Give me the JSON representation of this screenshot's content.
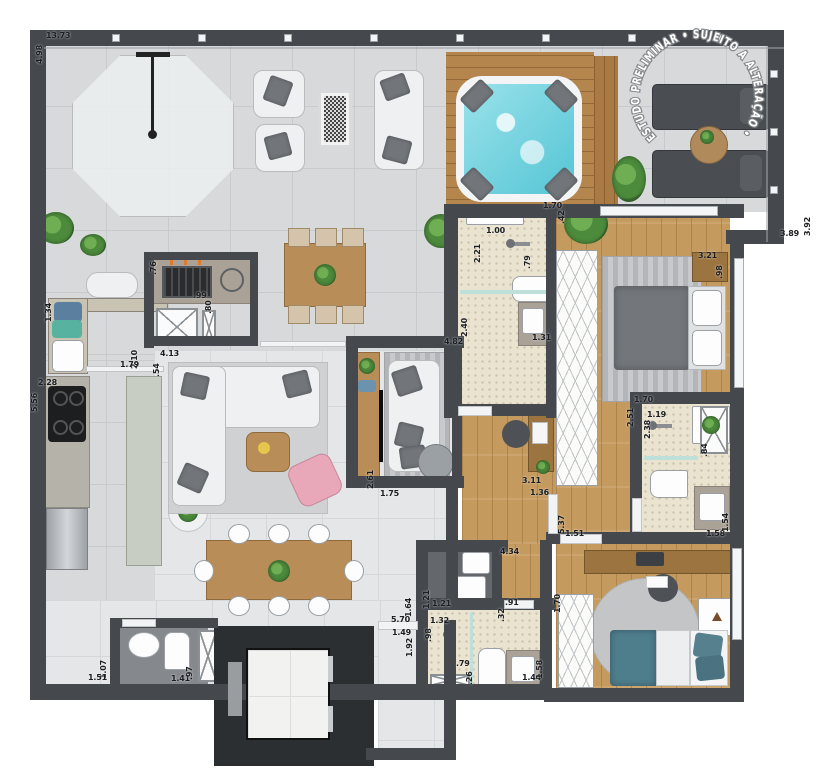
{
  "plan": {
    "watermark": "ESTUDO PRELIMINAR • SUJEITO A ALTERAÇÃO •",
    "colors": {
      "wall": "#45494e",
      "terrace_floor": "#d7d9db",
      "interior_floor": "#e4e6e8",
      "wood_floor": "#c59a5e",
      "deck_wood": "#b5854e",
      "bath_mosaic": "#eae3d0",
      "dark_floor": "#64676b",
      "jacuzzi_water": "#7fd8e2",
      "island_sage": "#c7cdc2",
      "accent_pink": "#e9a8b9",
      "bed_teal": "#4e7d8c",
      "plant_green": "#4c8a3c"
    },
    "dimensions": [
      {
        "v": "13.73",
        "x": 46,
        "y": 32,
        "r": 0
      },
      {
        "v": "4.98",
        "x": 36,
        "y": 64,
        "r": 1
      },
      {
        "v": "3.89",
        "x": 780,
        "y": 230,
        "r": 0
      },
      {
        "v": "3.92",
        "x": 804,
        "y": 236,
        "r": 1
      },
      {
        "v": "1.70",
        "x": 543,
        "y": 202,
        "r": 0
      },
      {
        "v": ".42",
        "x": 558,
        "y": 224,
        "r": 1
      },
      {
        "v": "1.00",
        "x": 486,
        "y": 227,
        "r": 0
      },
      {
        "v": "2.21",
        "x": 474,
        "y": 263,
        "r": 1
      },
      {
        "v": ".79",
        "x": 524,
        "y": 269,
        "r": 1
      },
      {
        "v": "2.40",
        "x": 461,
        "y": 337,
        "r": 1
      },
      {
        "v": "1.31",
        "x": 532,
        "y": 334,
        "r": 0
      },
      {
        "v": "4.82",
        "x": 444,
        "y": 338,
        "r": 0
      },
      {
        "v": "2.61",
        "x": 367,
        "y": 489,
        "r": 1
      },
      {
        "v": "1.75",
        "x": 380,
        "y": 490,
        "r": 0
      },
      {
        "v": "3.11",
        "x": 522,
        "y": 477,
        "r": 0
      },
      {
        "v": "1.36",
        "x": 530,
        "y": 489,
        "r": 0
      },
      {
        "v": "5.37",
        "x": 558,
        "y": 534,
        "r": 1
      },
      {
        "v": "1.51",
        "x": 565,
        "y": 530,
        "r": 0
      },
      {
        "v": "4.34",
        "x": 500,
        "y": 548,
        "r": 0
      },
      {
        "v": "3.21",
        "x": 698,
        "y": 252,
        "r": 0
      },
      {
        "v": ".98",
        "x": 716,
        "y": 279,
        "r": 1
      },
      {
        "v": "1.70",
        "x": 634,
        "y": 396,
        "r": 0
      },
      {
        "v": "2.51",
        "x": 627,
        "y": 427,
        "r": 1
      },
      {
        "v": "1.19",
        "x": 647,
        "y": 411,
        "r": 0
      },
      {
        "v": "2.38",
        "x": 644,
        "y": 439,
        "r": 1
      },
      {
        "v": ".84",
        "x": 701,
        "y": 457,
        "r": 1
      },
      {
        "v": "1.58",
        "x": 706,
        "y": 530,
        "r": 0
      },
      {
        "v": "1.54",
        "x": 722,
        "y": 532,
        "r": 1
      },
      {
        "v": "1.70",
        "x": 554,
        "y": 613,
        "r": 1
      },
      {
        "v": "1.21",
        "x": 423,
        "y": 609,
        "r": 1
      },
      {
        "v": "1.21",
        "x": 432,
        "y": 600,
        "r": 0
      },
      {
        "v": "1.32",
        "x": 430,
        "y": 617,
        "r": 0
      },
      {
        "v": ".98",
        "x": 425,
        "y": 642,
        "r": 1
      },
      {
        "v": ".91",
        "x": 505,
        "y": 599,
        "r": 0
      },
      {
        "v": ".32",
        "x": 498,
        "y": 622,
        "r": 1
      },
      {
        "v": ".79",
        "x": 456,
        "y": 660,
        "r": 0
      },
      {
        "v": ".26",
        "x": 466,
        "y": 685,
        "r": 1
      },
      {
        "v": "1.44",
        "x": 522,
        "y": 674,
        "r": 0
      },
      {
        "v": "1.58",
        "x": 536,
        "y": 679,
        "r": 1
      },
      {
        "v": "1.64",
        "x": 405,
        "y": 617,
        "r": 1
      },
      {
        "v": "5.70",
        "x": 391,
        "y": 616,
        "r": 0
      },
      {
        "v": "1.49",
        "x": 392,
        "y": 629,
        "r": 0
      },
      {
        "v": "1.92",
        "x": 406,
        "y": 657,
        "r": 1
      },
      {
        "v": "1.07",
        "x": 100,
        "y": 679,
        "r": 1
      },
      {
        "v": "1.51",
        "x": 88,
        "y": 674,
        "r": 0
      },
      {
        "v": "1.41",
        "x": 171,
        "y": 675,
        "r": 0
      },
      {
        "v": ".97",
        "x": 186,
        "y": 680,
        "r": 1
      },
      {
        "v": "2.10",
        "x": 131,
        "y": 369,
        "r": 1
      },
      {
        "v": "1.79",
        "x": 120,
        "y": 361,
        "r": 0
      },
      {
        "v": "2.28",
        "x": 38,
        "y": 379,
        "r": 0
      },
      {
        "v": "5.56",
        "x": 31,
        "y": 412,
        "r": 1
      },
      {
        "v": "1.34",
        "x": 45,
        "y": 322,
        "r": 1
      },
      {
        "v": "4.13",
        "x": 160,
        "y": 350,
        "r": 0
      },
      {
        "v": ".54",
        "x": 153,
        "y": 377,
        "r": 1
      },
      {
        "v": ".76",
        "x": 150,
        "y": 275,
        "r": 1
      },
      {
        "v": ".99",
        "x": 193,
        "y": 292,
        "r": 0
      },
      {
        "v": ".80",
        "x": 205,
        "y": 314,
        "r": 1
      }
    ]
  }
}
